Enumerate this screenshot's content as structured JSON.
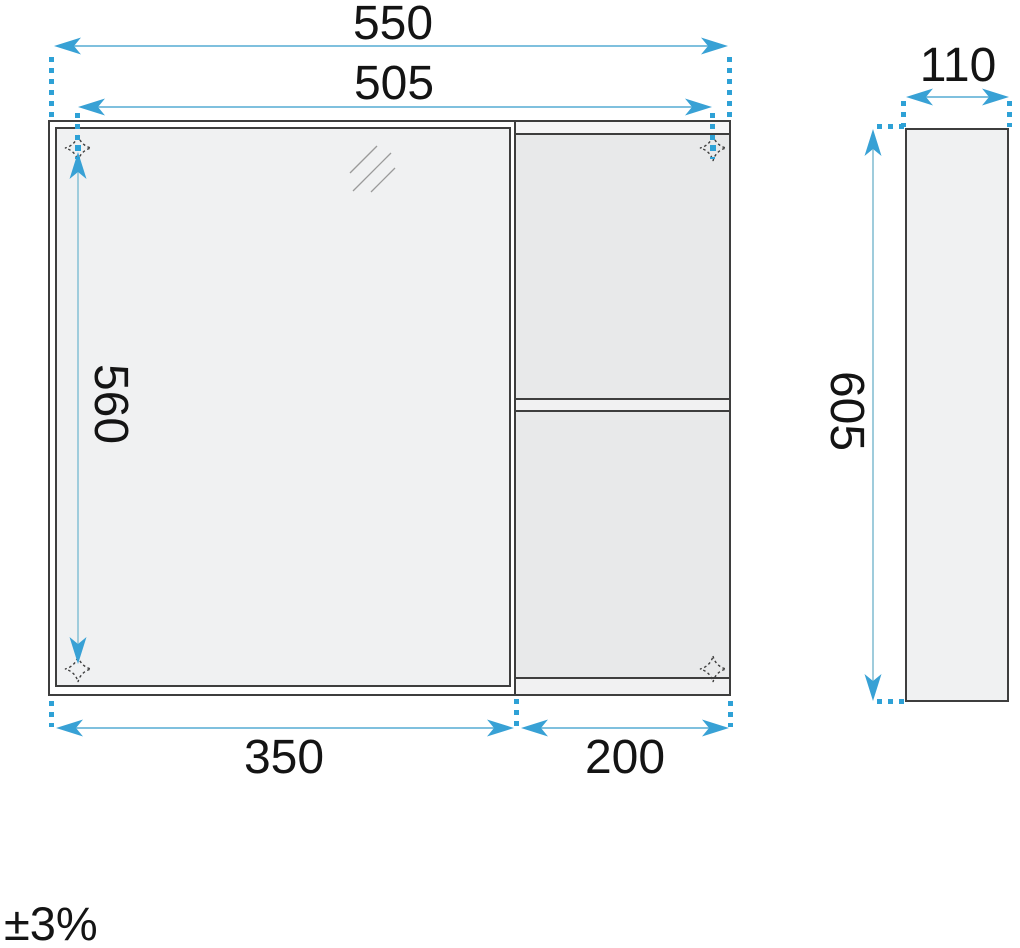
{
  "front_view": {
    "overall_width_mm": "550",
    "mounting_width_mm": "505",
    "mounting_height_mm": "560",
    "mirror_section_width_mm": "350",
    "shelf_section_width_mm": "200"
  },
  "side_view": {
    "depth_mm": "110",
    "height_mm": "605"
  },
  "tolerance_note": "±3%",
  "icons": {
    "mounting_point": "four-point-star-dotted",
    "mirror_reflection": "diagonal-slashes",
    "dimension_arrow": "swallowtail-arrow"
  },
  "colors": {
    "accent_blue": "#38a1d5",
    "dim_line_blue": "#7fc0de",
    "dotted_blue": "#2ea1d6",
    "outline_dark": "#3e3e3e",
    "mirror_fill": "#f0f1f2",
    "compartment_fill": "#e8e9ea",
    "text": "#141414"
  }
}
